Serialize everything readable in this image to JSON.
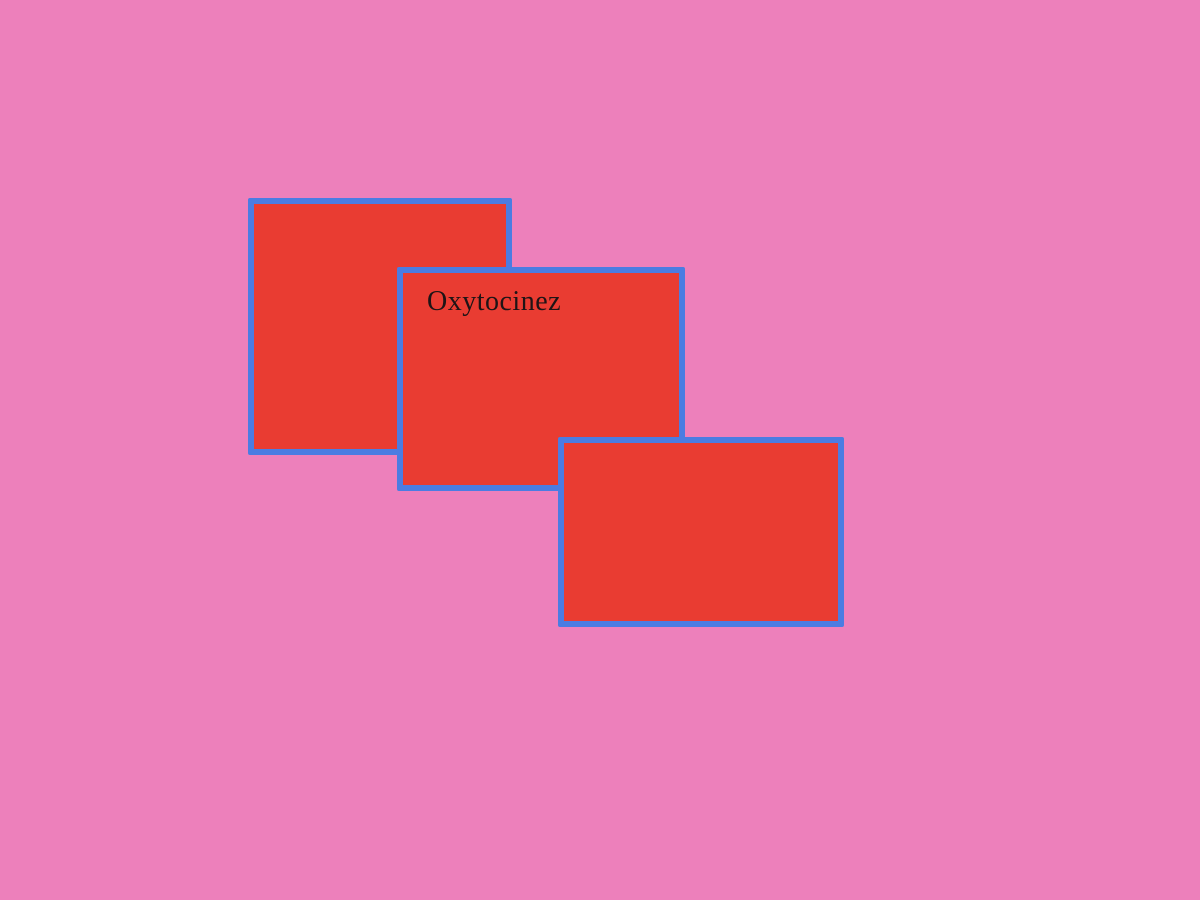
{
  "canvas": {
    "background_color": "#ed80bb",
    "width": 1200,
    "height": 900
  },
  "shape_style": {
    "fill_color": "#e93c32",
    "border_color": "#4b7ce2",
    "label_color": "#1e1416"
  },
  "cards": [
    {
      "label": ""
    },
    {
      "label": "Oxytocinez"
    },
    {
      "label": ""
    }
  ]
}
